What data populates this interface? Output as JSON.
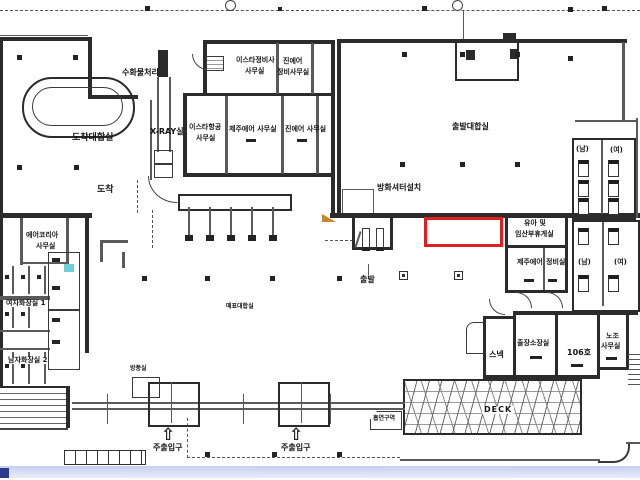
{
  "plan": {
    "type": "terminal-floor-plan",
    "highlight": {
      "color": "#dd2020"
    },
    "accent_teal": "#6ecfd6",
    "labels": {
      "baggage": "수화물처리장",
      "arrival_hall": "도착대합실",
      "arrival": "도착",
      "xray": "X-RAY실",
      "eastar_office_1": "이스타항공",
      "eastar_office_2": "사무실",
      "eastar_maint_1": "이스타정비사",
      "eastar_maint_2": "사무실",
      "jinair_maint_1": "진에어",
      "jinair_maint_2": "정비사무실",
      "jejuair_office": "제주에어 사무실",
      "jinair_office": "진에어 사무실",
      "departure_hall": "출발대합실",
      "fire_shutter": "방화셔터설치",
      "departure": "출발",
      "ticket_hall": "매표대합실",
      "infant_1": "유아 및",
      "infant_2": "임산부휴게실",
      "jejuair_room": "제주에어",
      "maint_room": "정비실",
      "men": "(남)",
      "women": "(여)",
      "snack": "스넥",
      "manager_room": "출장소장실",
      "room106": "106호",
      "union_1": "노조",
      "union_2": "사무실",
      "deck": "DECK",
      "smoking": "흡연구역",
      "entrance": "주출입구",
      "aircoria_1": "에어코리아",
      "aircoria_2": "사무실",
      "women_restroom": "여자화장실 1",
      "men_restroom": "남자화장실 2",
      "windbreak": "방풍실"
    }
  }
}
